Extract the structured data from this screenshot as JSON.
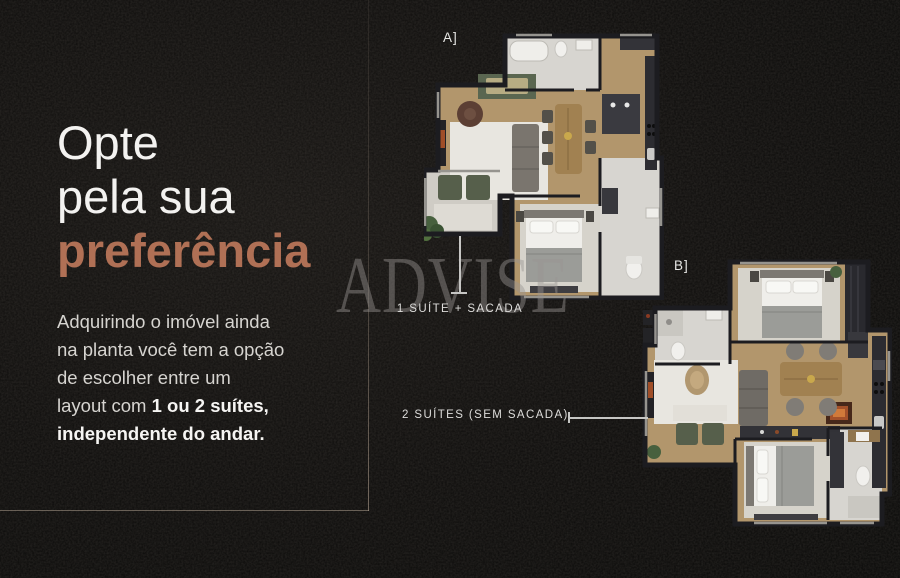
{
  "left_panel": {
    "heading": {
      "line1": "Opte",
      "line2": "pela sua",
      "line3_accent": "preferência"
    },
    "body": {
      "line1": "Adquirindo o imóvel ainda",
      "line2": "na planta você tem a opção",
      "line3": "de escolher entre um",
      "line4_normal": "layout com ",
      "line4_bold": "1 ou 2 suítes,",
      "line5_bold": "independente do andar."
    }
  },
  "watermark": {
    "text": "ADVISE"
  },
  "floor_plans": {
    "plan_a": {
      "label": "A]",
      "caption": "1 SUÍTE + SACADA"
    },
    "plan_b": {
      "label": "B]",
      "caption": "2 SUÍTES (SEM SACADA)"
    }
  },
  "palette": {
    "accent_copper": "#b07055",
    "background": "#0c0b0a",
    "wood_floor": "#b2966c",
    "tile_floor": "#d7d5d0",
    "rug": "#e8e6e0",
    "wall": "#1c1c20",
    "balcony_green": "#565f4b",
    "fire_glow": "#a3512a",
    "caption_text": "#dddcda"
  }
}
